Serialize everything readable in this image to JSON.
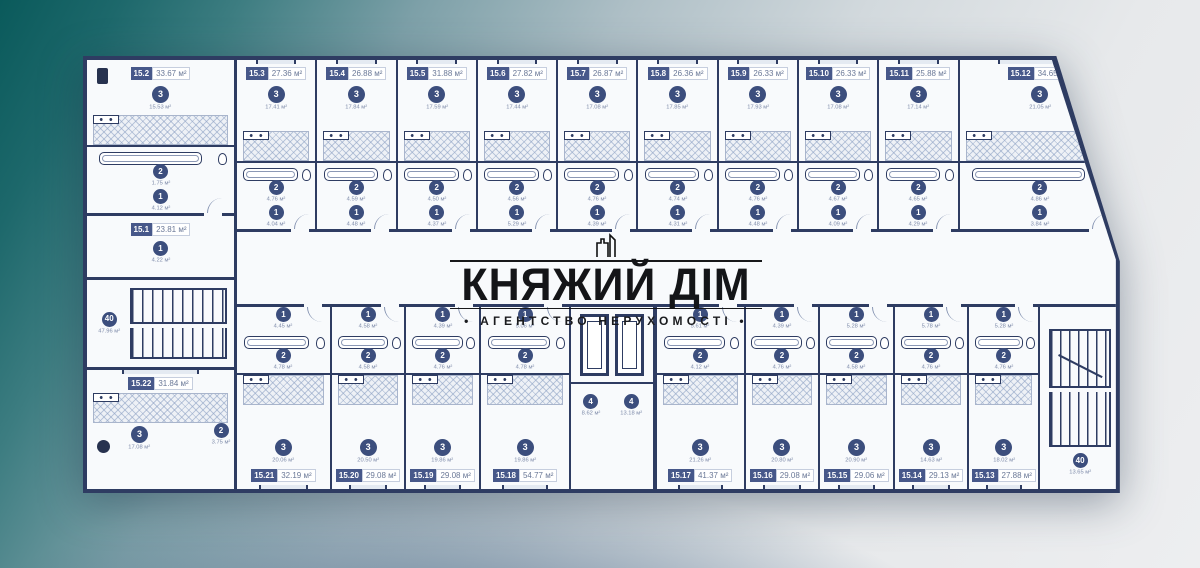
{
  "watermark": {
    "title": "КНЯЖИЙ ДІМ",
    "subtitle": "• АГЕНТСТВО НЕРУХОМОСТІ •",
    "icon": "building-towers-icon"
  },
  "colors": {
    "wall": "#2e3c62",
    "paper": "#f8fafc",
    "badge": "#47588a",
    "circle": "#3c4e7d",
    "bg_teal": "#0a5a5b",
    "bg_light": "#edeef0",
    "bg_steel": "#466484",
    "watermark_text": "#141518"
  },
  "floor_plan": {
    "area_unit": "м²",
    "left_column": {
      "units": [
        {
          "id": "15.2",
          "area": "33.67 м²",
          "column": "tl",
          "rooms": {
            "living": {
              "n": "3",
              "a": "15.53 м²"
            },
            "bath": {
              "n": "2",
              "a": "1.75 м²"
            },
            "hall": {
              "n": "1",
              "a": "4.12 м²"
            }
          }
        },
        {
          "id": "15.1",
          "area": "23.81 м²",
          "compact": true,
          "rooms": {
            "hall": {
              "n": "1",
              "a": "4.22 м²"
            }
          }
        }
      ],
      "stair": {
        "n": "40",
        "a": "47.96 м²"
      },
      "corner_unit": {
        "id": "15.22",
        "area": "31.84 м²",
        "column": "bl",
        "rooms": {
          "living": {
            "n": "3",
            "a": "17.08 м²"
          },
          "bath": {
            "n": "2",
            "a": "3.75 м²"
          }
        }
      }
    },
    "top_row": [
      {
        "id": "15.3",
        "area": "27.36 м²",
        "rooms": {
          "living": {
            "n": "3",
            "a": "17.41 м²"
          },
          "bath": {
            "n": "2",
            "a": "4.76 м²"
          },
          "hall": {
            "n": "1",
            "a": "4.04 м²"
          }
        }
      },
      {
        "id": "15.4",
        "area": "26.88 м²",
        "rooms": {
          "living": {
            "n": "3",
            "a": "17.84 м²"
          },
          "bath": {
            "n": "2",
            "a": "4.59 м²"
          },
          "hall": {
            "n": "1",
            "a": "4.48 м²"
          }
        }
      },
      {
        "id": "15.5",
        "area": "31.88 м²",
        "rooms": {
          "living": {
            "n": "3",
            "a": "17.59 м²"
          },
          "bath": {
            "n": "2",
            "a": "4.50 м²"
          },
          "hall": {
            "n": "1",
            "a": "4.37 м²"
          }
        }
      },
      {
        "id": "15.6",
        "area": "27.82 м²",
        "rooms": {
          "living": {
            "n": "3",
            "a": "17.44 м²"
          },
          "bath": {
            "n": "2",
            "a": "4.56 м²"
          },
          "hall": {
            "n": "1",
            "a": "5.29 м²"
          }
        }
      },
      {
        "id": "15.7",
        "area": "26.87 м²",
        "rooms": {
          "living": {
            "n": "3",
            "a": "17.08 м²"
          },
          "bath": {
            "n": "2",
            "a": "4.76 м²"
          },
          "hall": {
            "n": "1",
            "a": "4.39 м²"
          }
        }
      },
      {
        "id": "15.8",
        "area": "26.36 м²",
        "rooms": {
          "living": {
            "n": "3",
            "a": "17.85 м²"
          },
          "bath": {
            "n": "2",
            "a": "4.74 м²"
          },
          "hall": {
            "n": "1",
            "a": "4.31 м²"
          }
        }
      },
      {
        "id": "15.9",
        "area": "26.33 м²",
        "rooms": {
          "living": {
            "n": "3",
            "a": "17.93 м²"
          },
          "bath": {
            "n": "2",
            "a": "4.76 м²"
          },
          "hall": {
            "n": "1",
            "a": "4.48 м²"
          }
        }
      },
      {
        "id": "15.10",
        "area": "26.33 м²",
        "rooms": {
          "living": {
            "n": "3",
            "a": "17.08 м²"
          },
          "bath": {
            "n": "2",
            "a": "4.67 м²"
          },
          "hall": {
            "n": "1",
            "a": "4.09 м²"
          }
        }
      },
      {
        "id": "15.11",
        "area": "25.88 м²",
        "rooms": {
          "living": {
            "n": "3",
            "a": "17.14 м²"
          },
          "bath": {
            "n": "2",
            "a": "4.65 м²"
          },
          "hall": {
            "n": "1",
            "a": "4.29 м²"
          }
        }
      },
      {
        "id": "15.12",
        "area": "34.65 м²",
        "column": "tr",
        "rooms": {
          "living": {
            "n": "3",
            "a": "21.05 м²"
          },
          "bath": {
            "n": "2",
            "a": "4.86 м²"
          },
          "hall": {
            "n": "1",
            "a": "3.84 м²"
          }
        }
      }
    ],
    "bottom_row_left": [
      {
        "id": "15.21",
        "area": "32.19 м²",
        "rooms": {
          "living": {
            "n": "3",
            "a": "20.06 м²"
          },
          "bath": {
            "n": "2",
            "a": "4.78 м²"
          },
          "hall": {
            "n": "1",
            "a": "4.45 м²"
          }
        }
      },
      {
        "id": "15.20",
        "area": "29.08 м²",
        "rooms": {
          "living": {
            "n": "3",
            "a": "20.50 м²"
          },
          "bath": {
            "n": "2",
            "a": "4.58 м²"
          },
          "hall": {
            "n": "1",
            "a": "4.58 м²"
          }
        }
      },
      {
        "id": "15.19",
        "area": "29.08 м²",
        "rooms": {
          "living": {
            "n": "3",
            "a": "19.86 м²"
          },
          "bath": {
            "n": "2",
            "a": "4.76 м²"
          },
          "hall": {
            "n": "1",
            "a": "4.39 м²"
          }
        }
      },
      {
        "id": "15.18",
        "area": "54.77 м²",
        "rooms": {
          "living": {
            "n": "3",
            "a": "19.86 м²"
          },
          "bath": {
            "n": "2",
            "a": "4.78 м²"
          },
          "hall": {
            "n": "1",
            "a": "5.06 м²"
          }
        }
      }
    ],
    "elevator_core": {
      "shafts": 2,
      "lobby": [
        {
          "n": "4",
          "a": "8.62 м²"
        },
        {
          "n": "4",
          "a": "13.18 м²"
        }
      ]
    },
    "bottom_row_right": [
      {
        "id": "15.17",
        "area": "41.37 м²",
        "rooms": {
          "living": {
            "n": "3",
            "a": "21.26 м²"
          },
          "bath": {
            "n": "2",
            "a": "4.12 м²"
          },
          "hall": {
            "n": "1",
            "a": "5.61 м²"
          }
        }
      },
      {
        "id": "15.16",
        "area": "29.08 м²",
        "rooms": {
          "living": {
            "n": "3",
            "a": "20.80 м²"
          },
          "bath": {
            "n": "2",
            "a": "4.76 м²"
          },
          "hall": {
            "n": "1",
            "a": "4.39 м²"
          }
        }
      },
      {
        "id": "15.15",
        "area": "29.06 м²",
        "rooms": {
          "living": {
            "n": "3",
            "a": "20.90 м²"
          },
          "bath": {
            "n": "2",
            "a": "4.58 м²"
          },
          "hall": {
            "n": "1",
            "a": "5.28 м²"
          }
        }
      },
      {
        "id": "15.14",
        "area": "29.13 м²",
        "rooms": {
          "living": {
            "n": "3",
            "a": "14.63 м²"
          },
          "bath": {
            "n": "2",
            "a": "4.76 м²"
          },
          "hall": {
            "n": "1",
            "a": "5.78 м²"
          }
        }
      },
      {
        "id": "15.13",
        "area": "27.88 м²",
        "rooms": {
          "living": {
            "n": "3",
            "a": "18.02 м²"
          },
          "bath": {
            "n": "2",
            "a": "4.76 м²"
          },
          "hall": {
            "n": "1",
            "a": "5.28 м²"
          }
        }
      }
    ],
    "right_stair": {
      "n": "40",
      "a": "13.65 м²"
    }
  }
}
